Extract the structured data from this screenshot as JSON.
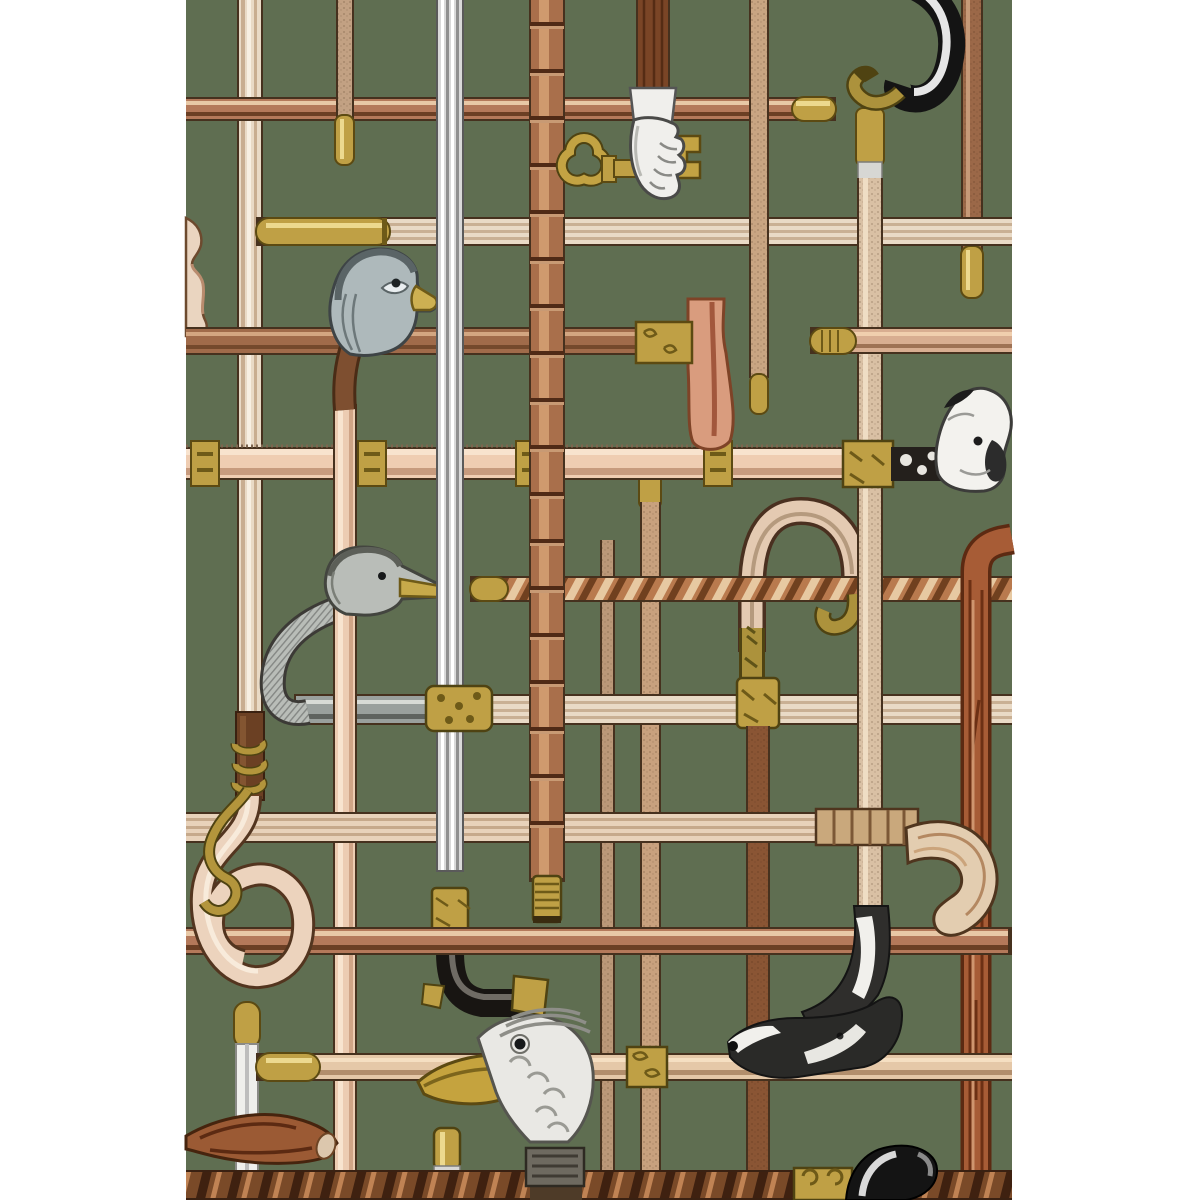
{
  "artwork": {
    "title": "Walking-sticks lattice wallpaper panel on green ground",
    "type": "decorative wallpaper pattern, no text",
    "background_color": "#5f6e51",
    "margin_color": "#ffffff",
    "pattern_bounds": {
      "left": 186,
      "right": 1012,
      "top": 0,
      "bottom": 1200
    },
    "motifs": {
      "background": {
        "label": "dark sage green ground with white side margins"
      },
      "urn": {
        "label": "partial urn-shaped cane handle at left edge"
      },
      "pheasant": {
        "label": "pheasant-head cane with yellow beak and pale shaft"
      },
      "hand_key": {
        "label": "gloved hand holding a gold key with heart-shaped bow"
      },
      "goose": {
        "label": "silver goose-head cane with gold beak and curved neck"
      },
      "axe": {
        "label": "axe-head cane with ornate gold collar"
      },
      "derby": {
        "label": "silver sword-stick with gold band and black derby handle"
      },
      "crook_pale": {
        "label": "pale shepherd-crook cane with carved gold tip and collar"
      },
      "crook_black": {
        "label": "black steel crook with gold carved tip, top right"
      },
      "dog": {
        "label": "spotted spaniel-head cane handle looking up"
      },
      "greyhound": {
        "label": "black and white greyhound-head cane handle"
      },
      "parrot": {
        "label": "silver parrot-head cane with large gold beak"
      },
      "tusk": {
        "label": "curved tusk-handle cane with wrapped grip"
      },
      "branch": {
        "label": "rustic branch cane at right edge"
      },
      "bamboo": {
        "label": "segmented bamboo cane with threaded brass ferrule"
      },
      "twisted": {
        "label": "spiral barley-twist cane with brass cap"
      },
      "antler": {
        "label": "sawn antler branch fragment, bottom left"
      },
      "loop_snake": {
        "label": "looped pretzel cane with coiled gold snake"
      },
      "black_handle": {
        "label": "polished black handle with gold capital on dark bottom cane"
      },
      "rods": {
        "label": "assorted crossing cane shafts with brass ferrule tips"
      }
    }
  },
  "palette": {
    "green": "#5f6e51",
    "white": "#ffffff",
    "outline": "#46311e",
    "copper": "#b4795a",
    "copper_hi": "#e8c8a6",
    "copper_sh": "#6b3f24",
    "pale": "#e9dac6",
    "pale_sh": "#c4ab8e",
    "pink": "#efcdb2",
    "pink_sh": "#c79b7e",
    "tan": "#c9a582",
    "brown": "#8a5534",
    "darkwood": "#7a4a28",
    "bamboo_c": "#a96f4b",
    "silver": "#d9d9d9",
    "silver_sh": "#8f8f8f",
    "black": "#181512",
    "brass": "#bfa045",
    "brass_hi": "#ecd98f",
    "brass_sh": "#6e5a18",
    "ivory": "#e3cdb0",
    "gray_bird": "#b9bdb8"
  }
}
